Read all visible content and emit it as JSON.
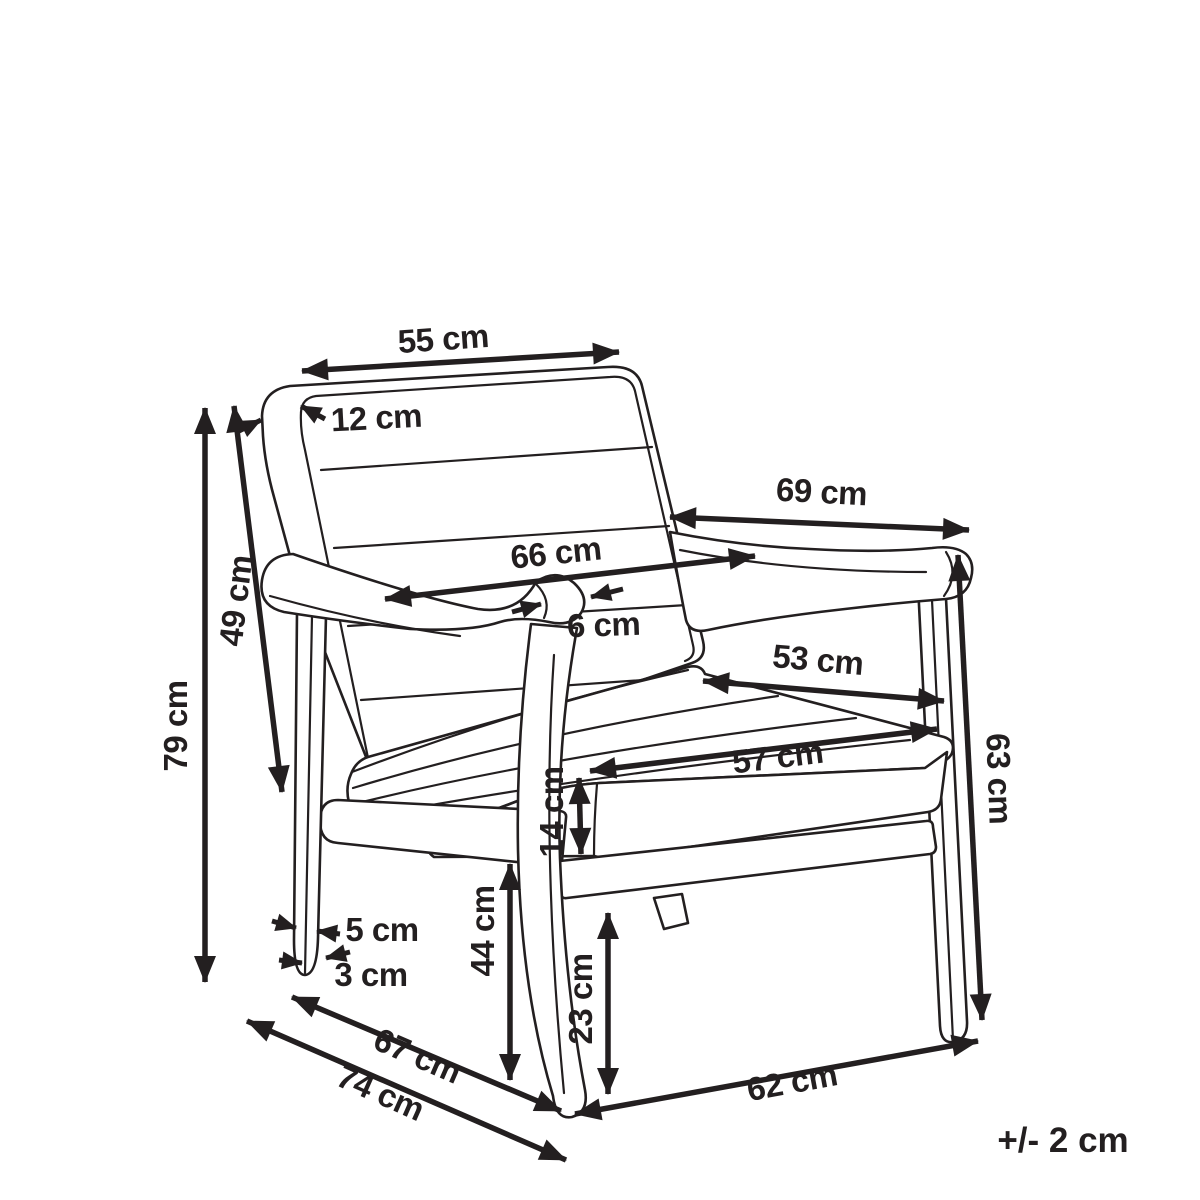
{
  "diagram": {
    "subject": "armchair-dimension-drawing",
    "unit": "cm",
    "tolerance_note": "+/- 2 cm",
    "ink_color": "#231f20",
    "background_color": "#ffffff",
    "dimensions": [
      {
        "id": "backrest-width",
        "label": "55 cm",
        "value": 55
      },
      {
        "id": "backrest-thickness",
        "label": "12 cm",
        "value": 12
      },
      {
        "id": "armrest-length",
        "label": "69 cm",
        "value": 69
      },
      {
        "id": "width-between-armrests",
        "label": "66 cm",
        "value": 66
      },
      {
        "id": "armrest-thickness",
        "label": "6 cm",
        "value": 6
      },
      {
        "id": "backrest-height",
        "label": "49 cm",
        "value": 49
      },
      {
        "id": "overall-height",
        "label": "79 cm",
        "value": 79
      },
      {
        "id": "seat-depth",
        "label": "53 cm",
        "value": 53
      },
      {
        "id": "seat-width",
        "label": "57 cm",
        "value": 57
      },
      {
        "id": "cushion-thickness",
        "label": "14 cm",
        "value": 14
      },
      {
        "id": "armrest-height",
        "label": "63 cm",
        "value": 63
      },
      {
        "id": "leg-width-top",
        "label": "5 cm",
        "value": 5
      },
      {
        "id": "leg-width-bottom",
        "label": "3 cm",
        "value": 3
      },
      {
        "id": "seat-height",
        "label": "44 cm",
        "value": 44
      },
      {
        "id": "under-seat-clearance",
        "label": "23 cm",
        "value": 23
      },
      {
        "id": "inner-depth",
        "label": "67 cm",
        "value": 67
      },
      {
        "id": "overall-depth",
        "label": "74 cm",
        "value": 74
      },
      {
        "id": "front-width",
        "label": "62 cm",
        "value": 62
      }
    ]
  }
}
